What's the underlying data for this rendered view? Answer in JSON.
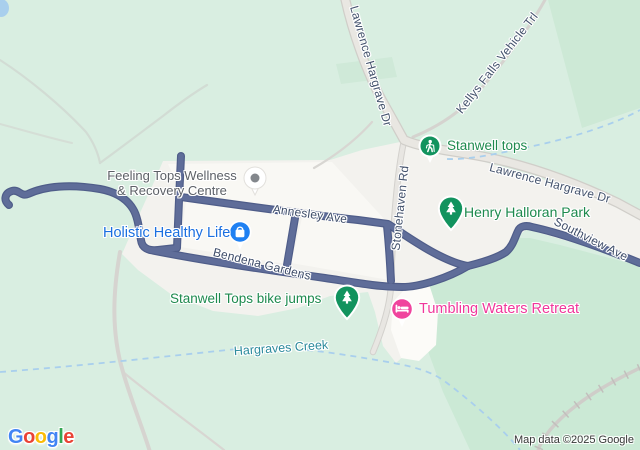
{
  "map": {
    "type": "google-maps-view",
    "location": "Stanwell Tops area",
    "roads": {
      "lawrence_top": "Lawrence Hargrave Dr",
      "lawrence_right": "Lawrence Hargrave Dr",
      "kellys": "Kellys Falls Vehicle Trl",
      "stonehaven": "Stonehaven Rd",
      "annesley": "Annesley Ave",
      "bendena": "Bendena Gardens",
      "southview": "Southview Ave"
    },
    "pois": {
      "stanwell_tops": "Stanwell tops",
      "henry_halloran": "Henry Halloran Park",
      "bike_jumps": "Stanwell Tops bike jumps",
      "holistic": "Holistic Healthy Life",
      "tumbling": "Tumbling Waters Retreat",
      "feeling_line1": "Feeling Tops Wellness",
      "feeling_line2": "& Recovery Centre"
    },
    "water": {
      "creek": "Hargraves Creek"
    },
    "icons": [
      "hiker-icon",
      "tree-pin-icon",
      "shopping-bag-icon",
      "bed-icon",
      "generic-place-dot-icon"
    ],
    "colors": {
      "land_green": "#d9eee1",
      "dark_green": "#cbe9d5",
      "urban": "#f3f2ee",
      "lot_white": "#f9f8f4",
      "road_fill": "#e9e7e2",
      "road_casing": "#d0cec9",
      "route_road": "#5f6d99",
      "creek_blue": "#a9cfed",
      "poi_green": "#1e8a4e",
      "poi_blue": "#1a6fe0",
      "poi_pink": "#f0379b",
      "marker_green": "#12935e",
      "marker_blue": "#1f80f2",
      "marker_pink": "#f0449d",
      "road_label": "#44536d",
      "water_label": "#2b8a9c"
    },
    "attribution": "Map data ©2025 Google",
    "logo": {
      "l1": "G",
      "l2": "o",
      "l3": "o",
      "l4": "g",
      "l5": "l",
      "l6": "e"
    }
  }
}
